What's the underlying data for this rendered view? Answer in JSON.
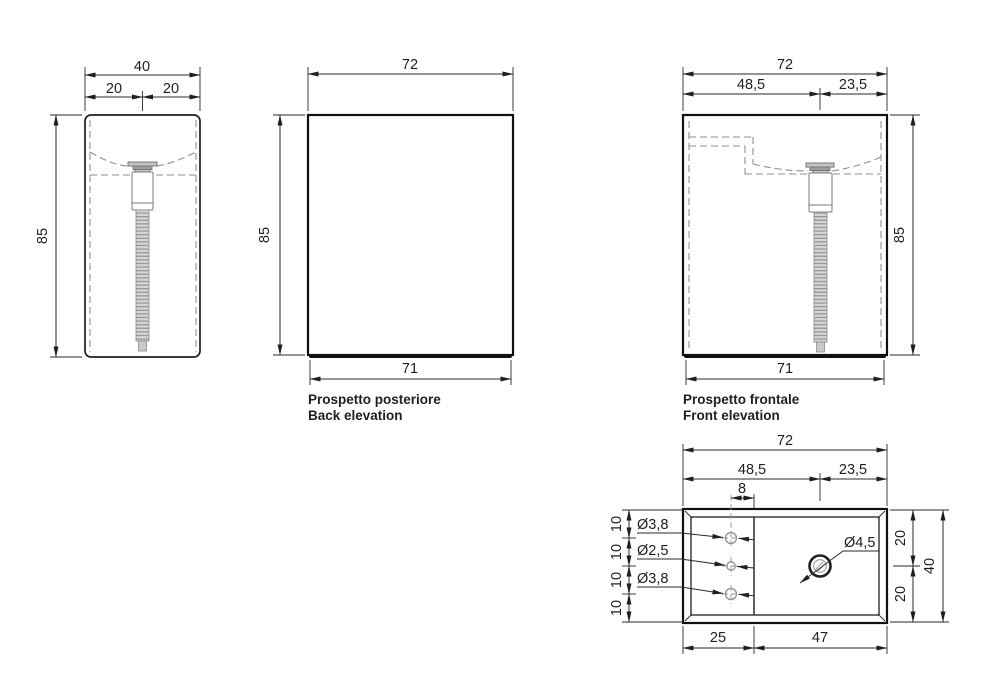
{
  "drawing_title": "Washbasin technical drawing",
  "colors": {
    "line": "#1f1f1f",
    "hidden_line": "#8f8f8f",
    "background": "#ffffff"
  },
  "views": {
    "side": {
      "dim_total_width": "40",
      "dim_left_half": "20",
      "dim_right_half": "20",
      "dim_height": "85"
    },
    "back": {
      "dim_width": "72",
      "dim_height": "85",
      "dim_base": "71",
      "title_it": "Prospetto posteriore",
      "title_en": "Back elevation"
    },
    "front": {
      "dim_width": "72",
      "dim_left": "48,5",
      "dim_right": "23,5",
      "dim_height": "85",
      "dim_base": "71",
      "title_it": "Prospetto frontale",
      "title_en": "Front elevation"
    },
    "plan": {
      "dim_width": "72",
      "dim_left": "48,5",
      "dim_right": "23,5",
      "dim_hole_offset": "8",
      "dim_row_spacing": [
        "10",
        "10",
        "10",
        "10"
      ],
      "hole_top": "Ø3,8",
      "hole_middle": "Ø2,5",
      "hole_bottom": "Ø3,8",
      "drain_hole": "Ø4,5",
      "dim_right_top": "20",
      "dim_right_bottom": "20",
      "dim_depth": "40",
      "dim_bottom_left": "25",
      "dim_bottom_right": "47"
    }
  }
}
